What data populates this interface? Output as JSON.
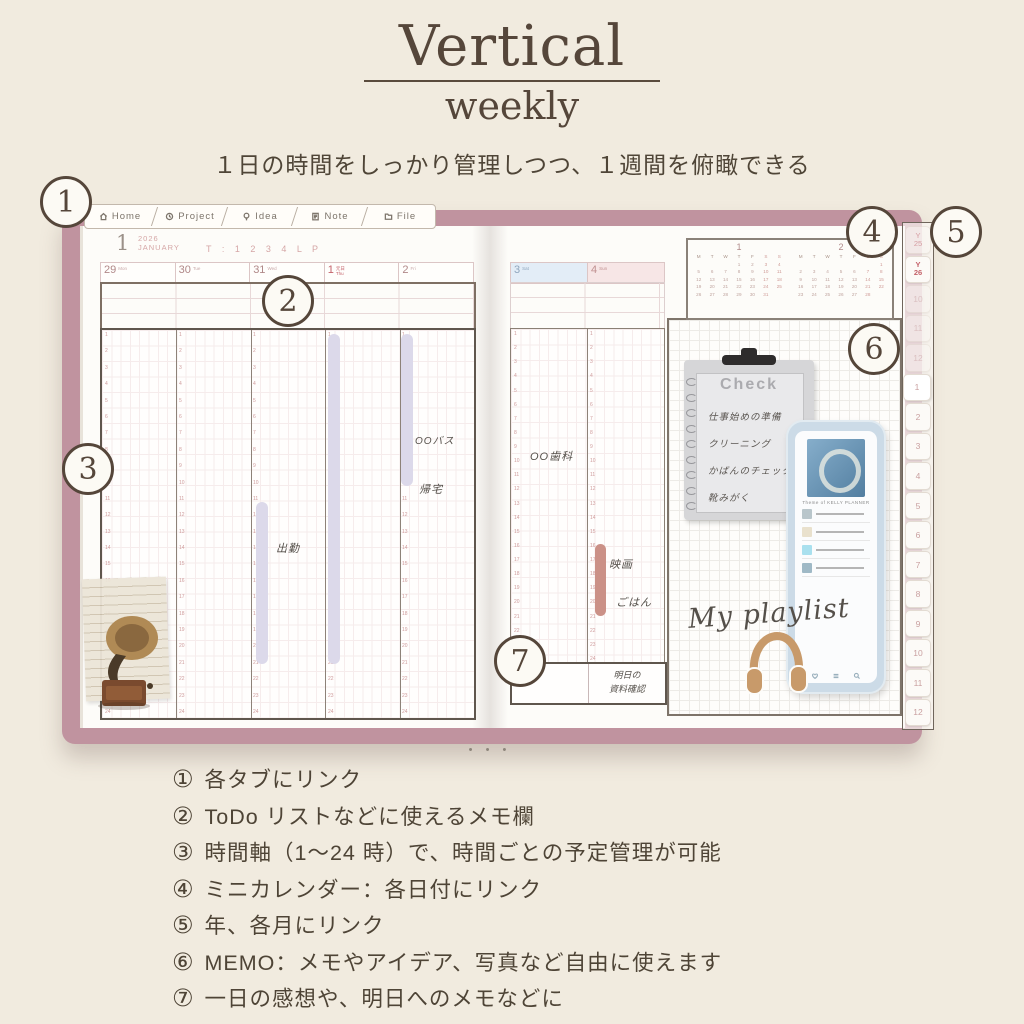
{
  "header": {
    "title": "Vertical",
    "subtitle": "weekly",
    "tagline": "１日の時間をしっかり管理しつつ、１週間を俯瞰できる"
  },
  "planner": {
    "nav_tabs": [
      {
        "label": "Home"
      },
      {
        "label": "Project"
      },
      {
        "label": "Idea"
      },
      {
        "label": "Note"
      },
      {
        "label": "File"
      }
    ],
    "left_page": {
      "month_number": "1",
      "year": "2026",
      "month_name": "JANUARY",
      "week_links": "T : 1 2 3 4 L P",
      "days": [
        {
          "date": "29",
          "weekday": "Mon"
        },
        {
          "date": "30",
          "weekday": "Tue"
        },
        {
          "date": "31",
          "weekday": "Wed"
        },
        {
          "date": "1",
          "weekday": "Thu",
          "holiday": "元日"
        },
        {
          "date": "2",
          "weekday": "Fri"
        }
      ],
      "entries": {
        "commute": "出勤",
        "bus": "OOバス",
        "home": "帰宅"
      }
    },
    "right_page": {
      "days": [
        {
          "date": "3",
          "weekday": "Sat"
        },
        {
          "date": "4",
          "weekday": "Sun"
        }
      ],
      "entries": {
        "dentist": "OO歯科",
        "movie": "映画",
        "dinner": "ごはん"
      },
      "bottom_note_line1": "明日の",
      "bottom_note_line2": "資料確認"
    },
    "time_axis": {
      "start": 1,
      "end": 24
    },
    "mini_calendars": {
      "weekday_header": [
        "M",
        "T",
        "W",
        "T",
        "F",
        "S",
        "S"
      ],
      "months": [
        {
          "label": "1",
          "weeks": [
            [
              "",
              "",
              "",
              "1",
              "2",
              "3",
              "4"
            ],
            [
              "5",
              "6",
              "7",
              "8",
              "9",
              "10",
              "11"
            ],
            [
              "12",
              "13",
              "14",
              "15",
              "16",
              "17",
              "18"
            ],
            [
              "19",
              "20",
              "21",
              "22",
              "23",
              "24",
              "25"
            ],
            [
              "26",
              "27",
              "28",
              "29",
              "30",
              "31",
              ""
            ]
          ]
        },
        {
          "label": "2",
          "weeks": [
            [
              "",
              "",
              "",
              "",
              "",
              "",
              "1"
            ],
            [
              "2",
              "3",
              "4",
              "5",
              "6",
              "7",
              "8"
            ],
            [
              "9",
              "10",
              "11",
              "12",
              "13",
              "14",
              "15"
            ],
            [
              "16",
              "17",
              "18",
              "19",
              "20",
              "21",
              "22"
            ],
            [
              "23",
              "24",
              "25",
              "26",
              "27",
              "28",
              ""
            ]
          ]
        }
      ]
    },
    "side_tabs": [
      {
        "label": "Y25",
        "type": "year-past"
      },
      {
        "label": "Y26",
        "type": "year"
      },
      {
        "label": "10",
        "type": "faded"
      },
      {
        "label": "11",
        "type": "faded"
      },
      {
        "label": "12",
        "type": "faded"
      },
      {
        "label": "1",
        "type": "active"
      },
      {
        "label": "2",
        "type": ""
      },
      {
        "label": "3",
        "type": ""
      },
      {
        "label": "4",
        "type": ""
      },
      {
        "label": "5",
        "type": ""
      },
      {
        "label": "6",
        "type": ""
      },
      {
        "label": "7",
        "type": ""
      },
      {
        "label": "8",
        "type": ""
      },
      {
        "label": "9",
        "type": ""
      },
      {
        "label": "10",
        "type": ""
      },
      {
        "label": "11",
        "type": ""
      },
      {
        "label": "12",
        "type": ""
      }
    ],
    "memo": {
      "check_title": "Check",
      "check_items": [
        "仕事始めの準備",
        "クリーニング",
        "かばんのチェック",
        "靴みがく"
      ],
      "phone_title": "Theme of KELLY PLANNER",
      "track_thumb_colors": [
        "#b9c6cb",
        "#e9e1cd",
        "#a9e0ee",
        "#9fb9c6"
      ],
      "playlist_caption": "My playlist"
    },
    "page_dots": "• • •"
  },
  "callouts": [
    "1",
    "2",
    "3",
    "4",
    "5",
    "6",
    "7"
  ],
  "features": {
    "items": [
      {
        "marker": "①",
        "text": "各タブにリンク"
      },
      {
        "marker": "②",
        "text": "ToDo リストなどに使えるメモ欄"
      },
      {
        "marker": "③",
        "text": "時間軸（1～24 時）で、時間ごとの予定管理が可能"
      },
      {
        "marker": "④",
        "text": "ミニカレンダー：各日付にリンク"
      },
      {
        "marker": "⑤",
        "text": "年、各月にリンク"
      },
      {
        "marker": "⑥",
        "text": "MEMO：メモやアイデア、写真など自由に使えます"
      },
      {
        "marker": "⑦",
        "text": "一日の感想や、明日へのメモなどに"
      }
    ]
  },
  "colors": {
    "cover": "#c0939f",
    "holiday_red": "#c4626a",
    "saturday_blue": "#8fa6bd",
    "event_purple": "#dcd9ea",
    "event_pink": "#cb9187",
    "background_cream": "#f1ebdf"
  }
}
